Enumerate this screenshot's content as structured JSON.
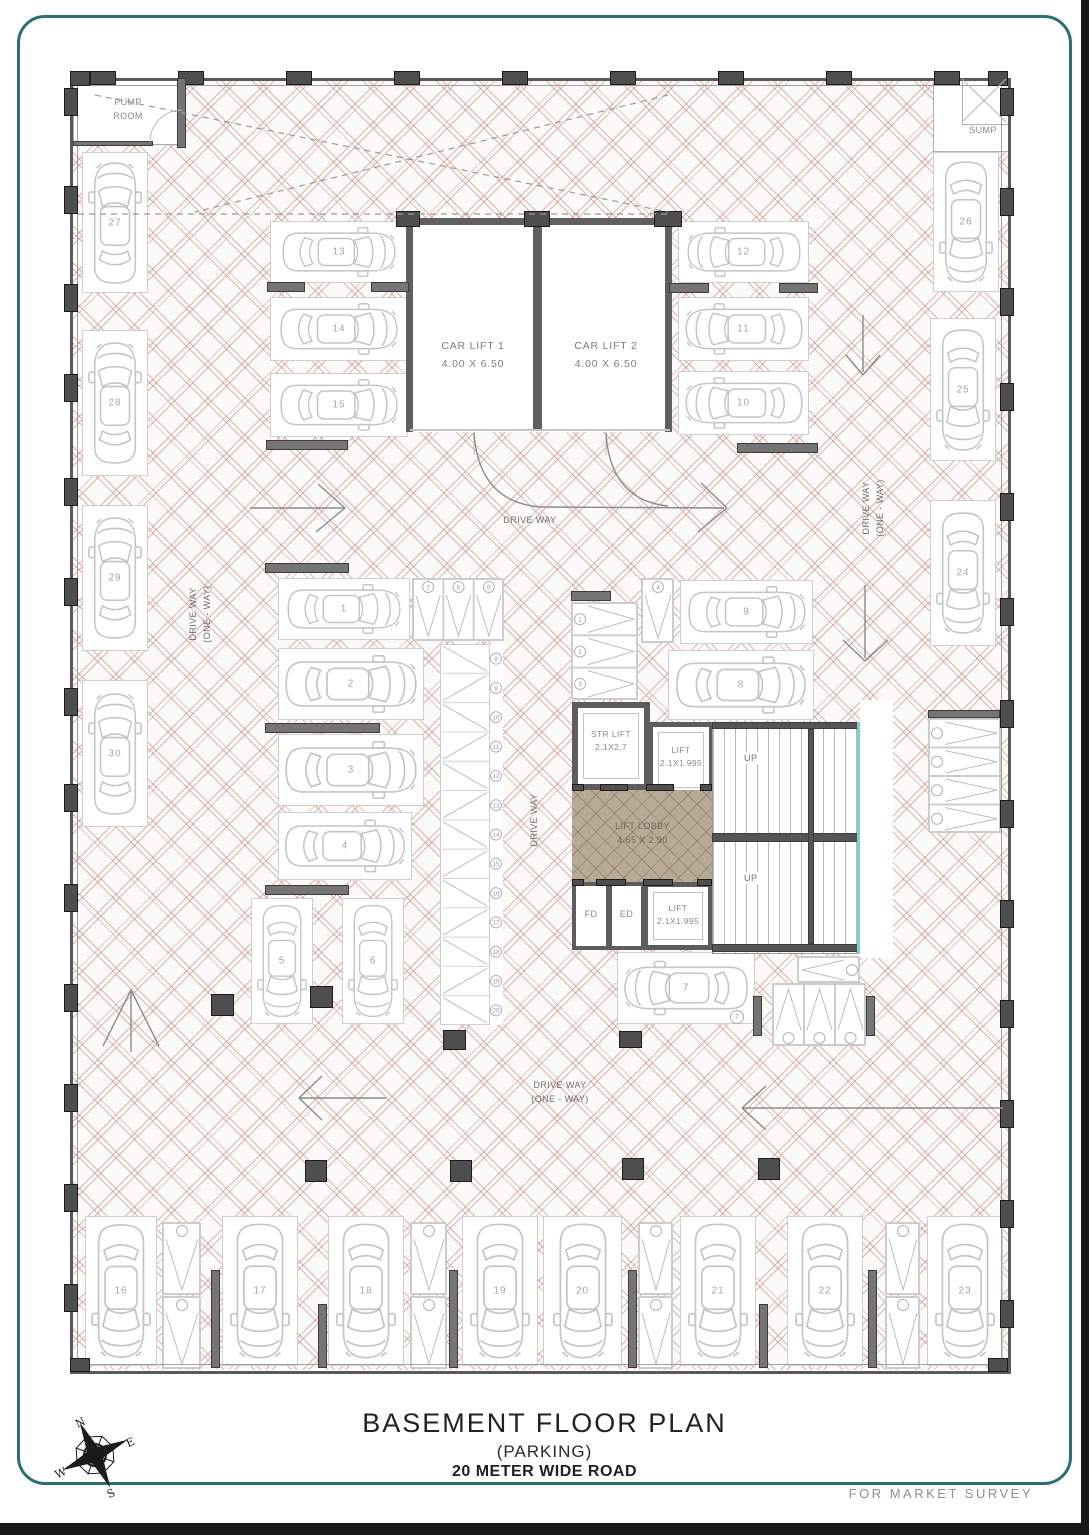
{
  "page": {
    "title_line1": "BASEMENT  FLOOR PLAN",
    "title_line2": "(PARKING)",
    "title_line3": "20 METER WIDE ROAD",
    "footer_note": "FOR MARKET SURVEY"
  },
  "compass": {
    "n": "N",
    "e": "E",
    "s": "S",
    "w": "W"
  },
  "labels": {
    "pump_line1": "PUMP",
    "pump_line2": "ROOM",
    "sump": "SUMP",
    "car_lift_1_name": "CAR LIFT 1",
    "car_lift_1_size": "4.00 X 6.50",
    "car_lift_2_name": "CAR LIFT 2",
    "car_lift_2_size": "4.00 X 6.50",
    "str_lift_name": "STR LIFT",
    "str_lift_size": "2.1X2.7",
    "lift_top_name": "LIFT",
    "lift_top_size": "2.1X1.995",
    "lift_bottom_name": "LIFT",
    "lift_bottom_size": "2.1X1.995",
    "lobby_name": "LIFT LOBBY",
    "lobby_size": "4.65 X 2.90",
    "fd": "FD",
    "ed": "ED",
    "up": "UP",
    "drive_way": "DRIVE WAY",
    "one_way": "(ONE - WAY)"
  },
  "colors": {
    "frame": "#2c6f70",
    "hatch": "#bb7369",
    "wall": "#5a5a5a",
    "lobby_fill": "#b9a997",
    "stair_strip": "#7ccdd2"
  },
  "car_spots": [
    {
      "n": "1",
      "x": 278,
      "y": 578,
      "w": 132,
      "h": 62,
      "dir": "right"
    },
    {
      "n": "2",
      "x": 278,
      "y": 648,
      "w": 146,
      "h": 72,
      "dir": "right"
    },
    {
      "n": "3",
      "x": 278,
      "y": 734,
      "w": 146,
      "h": 72,
      "dir": "right"
    },
    {
      "n": "4",
      "x": 278,
      "y": 812,
      "w": 134,
      "h": 68,
      "dir": "right"
    },
    {
      "n": "5",
      "x": 251,
      "y": 898,
      "w": 62,
      "h": 126,
      "dir": "down"
    },
    {
      "n": "6",
      "x": 342,
      "y": 898,
      "w": 62,
      "h": 126,
      "dir": "down"
    },
    {
      "n": "7",
      "x": 617,
      "y": 952,
      "w": 138,
      "h": 72,
      "dir": "left"
    },
    {
      "n": "8",
      "x": 668,
      "y": 650,
      "w": 146,
      "h": 70,
      "dir": "right"
    },
    {
      "n": "9",
      "x": 680,
      "y": 580,
      "w": 133,
      "h": 64,
      "dir": "right"
    },
    {
      "n": "10",
      "x": 678,
      "y": 371,
      "w": 131,
      "h": 64,
      "dir": "left"
    },
    {
      "n": "11",
      "x": 678,
      "y": 297,
      "w": 131,
      "h": 64,
      "dir": "left"
    },
    {
      "n": "12",
      "x": 678,
      "y": 221,
      "w": 131,
      "h": 62,
      "dir": "left"
    },
    {
      "n": "13",
      "x": 270,
      "y": 221,
      "w": 138,
      "h": 62,
      "dir": "right"
    },
    {
      "n": "14",
      "x": 270,
      "y": 297,
      "w": 138,
      "h": 64,
      "dir": "right"
    },
    {
      "n": "15",
      "x": 270,
      "y": 373,
      "w": 138,
      "h": 64,
      "dir": "right"
    },
    {
      "n": "16",
      "x": 85,
      "y": 1216,
      "w": 72,
      "h": 150,
      "dir": "down"
    },
    {
      "n": "17",
      "x": 222,
      "y": 1216,
      "w": 76,
      "h": 150,
      "dir": "down"
    },
    {
      "n": "18",
      "x": 328,
      "y": 1216,
      "w": 76,
      "h": 150,
      "dir": "down"
    },
    {
      "n": "19",
      "x": 462,
      "y": 1216,
      "w": 76,
      "h": 150,
      "dir": "down"
    },
    {
      "n": "20",
      "x": 543,
      "y": 1216,
      "w": 79,
      "h": 150,
      "dir": "down"
    },
    {
      "n": "21",
      "x": 680,
      "y": 1216,
      "w": 76,
      "h": 150,
      "dir": "down"
    },
    {
      "n": "22",
      "x": 787,
      "y": 1216,
      "w": 76,
      "h": 150,
      "dir": "down"
    },
    {
      "n": "23",
      "x": 927,
      "y": 1216,
      "w": 76,
      "h": 150,
      "dir": "down"
    },
    {
      "n": "24",
      "x": 930,
      "y": 500,
      "w": 66,
      "h": 146,
      "dir": "down"
    },
    {
      "n": "25",
      "x": 930,
      "y": 318,
      "w": 66,
      "h": 143,
      "dir": "down"
    },
    {
      "n": "26",
      "x": 933,
      "y": 152,
      "w": 66,
      "h": 140,
      "dir": "down"
    },
    {
      "n": "27",
      "x": 82,
      "y": 152,
      "w": 66,
      "h": 141,
      "dir": "up"
    },
    {
      "n": "28",
      "x": 82,
      "y": 330,
      "w": 66,
      "h": 146,
      "dir": "up"
    },
    {
      "n": "29",
      "x": 82,
      "y": 505,
      "w": 66,
      "h": 146,
      "dir": "up"
    },
    {
      "n": "30",
      "x": 82,
      "y": 680,
      "w": 66,
      "h": 147,
      "dir": "up"
    }
  ],
  "bike_groups": [
    {
      "x": 412,
      "y": 578,
      "w": 91,
      "h": 62,
      "layout": "cols",
      "circle": "top",
      "numbers": [
        "7",
        "6",
        "5"
      ]
    },
    {
      "x": 440,
      "y": 644,
      "w": 63,
      "h": 381,
      "layout": "zigzag",
      "circle": "right",
      "numbers": [
        "8",
        "9",
        "10",
        "11",
        "12",
        "13",
        "14",
        "15",
        "16",
        "17",
        "18",
        "19",
        "20"
      ]
    },
    {
      "x": 571,
      "y": 602,
      "w": 66,
      "h": 97,
      "layout": "rows",
      "circle": "left",
      "numbers": [
        "1",
        "2",
        "3"
      ]
    },
    {
      "x": 641,
      "y": 578,
      "w": 32,
      "h": 64,
      "layout": "cols",
      "circle": "top",
      "numbers": [
        "4"
      ]
    },
    {
      "x": 772,
      "y": 983,
      "w": 93,
      "h": 62,
      "layout": "cols",
      "circle": "bottom",
      "numbers": [
        "",
        "",
        ""
      ]
    },
    {
      "x": 797,
      "y": 956,
      "w": 62,
      "h": 26,
      "layout": "rows",
      "circle": "right",
      "numbers": [
        ""
      ]
    },
    {
      "x": 928,
      "y": 718,
      "w": 72,
      "h": 114,
      "layout": "rows",
      "circle": "left",
      "numbers": [
        "",
        "",
        "",
        ""
      ]
    },
    {
      "x": 162,
      "y": 1222,
      "w": 38,
      "h": 72,
      "layout": "cols",
      "circle": "top",
      "numbers": [
        ""
      ]
    },
    {
      "x": 162,
      "y": 1296,
      "w": 38,
      "h": 72,
      "layout": "cols",
      "circle": "top",
      "numbers": [
        ""
      ]
    },
    {
      "x": 410,
      "y": 1222,
      "w": 36,
      "h": 72,
      "layout": "cols",
      "circle": "top",
      "numbers": [
        ""
      ]
    },
    {
      "x": 410,
      "y": 1296,
      "w": 36,
      "h": 72,
      "layout": "cols",
      "circle": "top",
      "numbers": [
        ""
      ]
    },
    {
      "x": 638,
      "y": 1222,
      "w": 34,
      "h": 72,
      "layout": "cols",
      "circle": "top",
      "numbers": [
        ""
      ]
    },
    {
      "x": 638,
      "y": 1296,
      "w": 34,
      "h": 72,
      "layout": "cols",
      "circle": "top",
      "numbers": [
        ""
      ]
    },
    {
      "x": 885,
      "y": 1222,
      "w": 34,
      "h": 72,
      "layout": "cols",
      "circle": "top",
      "numbers": [
        ""
      ]
    },
    {
      "x": 885,
      "y": 1296,
      "w": 34,
      "h": 72,
      "layout": "cols",
      "circle": "top",
      "numbers": [
        ""
      ]
    }
  ],
  "extra_circles": [
    {
      "x": 730,
      "y": 1010,
      "n": "7"
    }
  ]
}
